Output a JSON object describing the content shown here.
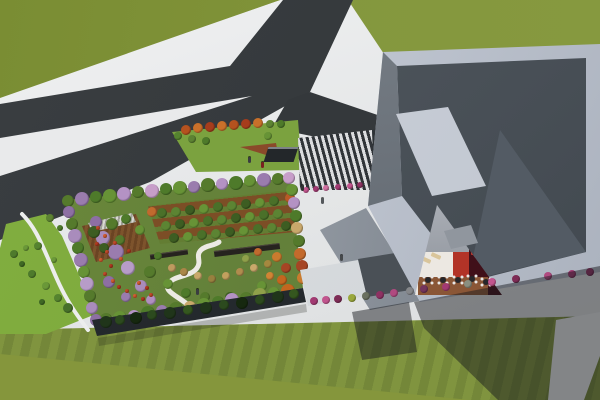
{
  "meta": {
    "description": "Aerial 3D architectural rendering: forked dark road through green field (top-left), long low building with colorful rooftop garden (center-left), large angular grey building with skylights and sunken courtyard terrace (right), striped lawns, pink street bushes and long cast shadows (bottom)."
  },
  "palette": {
    "grass_top": "#7f9238",
    "grass_right": "#86993f",
    "grass_plain": "#85963c",
    "lawn_stripe_a": "#80943f",
    "lawn_stripe_b": "#748739",
    "pavement": "#e7e9ea",
    "road": "#34383b",
    "road_island": "#e9eaeb",
    "patch_lawn": "#7ba23f",
    "strip_green": "#82af40",
    "garden_lawn": "#6c8a3b",
    "orchard_soil": "#7c4e26",
    "orchard_grass": "#637d33",
    "deck_a": "#6b4423",
    "deck_b": "#7d532c",
    "facade": "#22272b",
    "parapet_hi": "#d6dbe4",
    "parapet_lo": "#a9b0bc",
    "roof_hi": "#5a6269",
    "roof_lo": "#40474e",
    "skylight": "#ced3db",
    "wall_hi": "#b3b9c0",
    "wall_lo": "#6e757d",
    "annex_light": "#dfe2e5",
    "annex_dark": "#4a5056",
    "court_wall": "#989da5",
    "court_white": "#ece8e2",
    "court_red": "#b23327",
    "court_maroon": "#401019",
    "court_brown": "#8a5636",
    "path_white": "#eceae4",
    "shadow": "rgba(22,26,30,0.48)"
  },
  "scene": {
    "dot_groups": {
      "patch_trees": [
        [
          186,
          130,
          5,
          "#b5521f"
        ],
        [
          198,
          128,
          5,
          "#c9702a"
        ],
        [
          210,
          127,
          5,
          "#a63c1c"
        ],
        [
          222,
          126,
          5,
          "#c9702a"
        ],
        [
          234,
          125,
          5,
          "#b5521f"
        ],
        [
          246,
          124,
          5,
          "#a63c1c"
        ],
        [
          258,
          123,
          5,
          "#c9702a"
        ],
        [
          270,
          124,
          4,
          "#5d8333"
        ],
        [
          281,
          124,
          4,
          "#4e7a2a"
        ],
        [
          178,
          136,
          4,
          "#55832f"
        ],
        [
          192,
          139,
          4,
          "#5d8333"
        ],
        [
          206,
          141,
          4,
          "#4e7a2a"
        ],
        [
          268,
          136,
          4,
          "#679336"
        ]
      ],
      "plaza_flowers": [
        [
          306,
          190,
          3,
          "#c2558e"
        ],
        [
          316,
          189,
          3,
          "#a23a72"
        ],
        [
          326,
          188,
          3,
          "#d06fa0"
        ],
        [
          338,
          187,
          3,
          "#a23a72"
        ],
        [
          350,
          186,
          3,
          "#c2558e"
        ],
        [
          360,
          185,
          3,
          "#8e3263"
        ]
      ],
      "strip_bushes": [
        [
          14,
          254,
          4,
          "#4e7a2c"
        ],
        [
          26,
          248,
          3,
          "#6a9838"
        ],
        [
          38,
          246,
          4,
          "#55832f"
        ],
        [
          22,
          264,
          3,
          "#3f6824"
        ],
        [
          32,
          274,
          4,
          "#4e7a2c"
        ],
        [
          46,
          286,
          4,
          "#6a9838"
        ],
        [
          58,
          298,
          4,
          "#55832f"
        ],
        [
          68,
          308,
          5,
          "#47702a"
        ],
        [
          42,
          302,
          3,
          "#3f6824"
        ],
        [
          54,
          260,
          3,
          "#6a9838"
        ],
        [
          50,
          218,
          4,
          "#5d8333"
        ],
        [
          60,
          228,
          3,
          "#4e7a2a"
        ]
      ],
      "garden_interior": [
        [
          103,
          238,
          7,
          "#a98cbc"
        ],
        [
          116,
          252,
          8,
          "#9a7cae"
        ],
        [
          128,
          268,
          7,
          "#b79cc8"
        ],
        [
          109,
          282,
          6,
          "#8d6fa3"
        ],
        [
          141,
          286,
          6,
          "#a98cbc"
        ],
        [
          126,
          297,
          5,
          "#9a7cae"
        ],
        [
          96,
          222,
          6,
          "#8d6fa3"
        ],
        [
          151,
          300,
          5,
          "#b08fc0"
        ],
        [
          94,
          232,
          6,
          "#3d5d22"
        ],
        [
          112,
          224,
          6,
          "#557a2c"
        ],
        [
          126,
          219,
          5,
          "#4e7a2a"
        ],
        [
          140,
          230,
          5,
          "#679336"
        ],
        [
          104,
          248,
          5,
          "#3d5d22"
        ],
        [
          120,
          240,
          5,
          "#557a2c"
        ],
        [
          150,
          272,
          6,
          "#557a2c"
        ],
        [
          168,
          284,
          5,
          "#679336"
        ],
        [
          186,
          293,
          5,
          "#4e7a2a"
        ],
        [
          205,
          297,
          5,
          "#557a2c"
        ],
        [
          230,
          297,
          5,
          "#3d5d22"
        ],
        [
          262,
          286,
          5,
          "#679336"
        ],
        [
          158,
          256,
          4,
          "#4e7a2a"
        ],
        [
          172,
          268,
          4,
          "#bf9a5f"
        ],
        [
          184,
          272,
          4,
          "#aa8648"
        ],
        [
          198,
          276,
          4,
          "#c9a86b"
        ],
        [
          212,
          279,
          4,
          "#98803f"
        ],
        [
          226,
          276,
          4,
          "#c2a05e"
        ],
        [
          240,
          272,
          4,
          "#b08c4e"
        ],
        [
          254,
          268,
          4,
          "#c9a86b"
        ],
        [
          268,
          264,
          4,
          "#a5883f"
        ],
        [
          246,
          259,
          4,
          "#8fa04a"
        ],
        [
          258,
          252,
          4,
          "#c06a2e"
        ],
        [
          277,
          257,
          5,
          "#c97b2e"
        ],
        [
          286,
          268,
          5,
          "#a64524"
        ],
        [
          282,
          280,
          5,
          "#c3661f"
        ],
        [
          270,
          276,
          4,
          "#d08434"
        ]
      ],
      "flower_dots": [
        [
          98,
          228,
          2,
          "#c0492a"
        ],
        [
          105,
          236,
          2,
          "#d15c30"
        ],
        [
          97,
          244,
          2,
          "#b03a20"
        ],
        [
          107,
          252,
          2,
          "#c0492a"
        ],
        [
          101,
          260,
          2,
          "#d15c30"
        ],
        [
          111,
          266,
          2,
          "#b03a20"
        ],
        [
          105,
          274,
          2,
          "#c0492a"
        ],
        [
          113,
          281,
          2,
          "#d15c30"
        ],
        [
          119,
          287,
          2,
          "#b03a20"
        ],
        [
          127,
          291,
          2,
          "#c0492a"
        ],
        [
          135,
          296,
          2,
          "#d15c30"
        ],
        [
          143,
          299,
          2,
          "#b03a20"
        ],
        [
          151,
          295,
          2,
          "#c0492a"
        ],
        [
          121,
          259,
          2,
          "#d15c30"
        ],
        [
          129,
          251,
          2,
          "#b03a20"
        ],
        [
          115,
          243,
          2,
          "#c0492a"
        ],
        [
          139,
          283,
          2,
          "#d15c30"
        ],
        [
          147,
          288,
          2,
          "#b03a20"
        ]
      ],
      "orchard_trees": [
        [
          162,
          213,
          5,
          "#4a7029"
        ],
        [
          176,
          212,
          5,
          "#5c8433"
        ],
        [
          190,
          210,
          5,
          "#3d5d22"
        ],
        [
          204,
          209,
          5,
          "#679336"
        ],
        [
          218,
          207,
          5,
          "#4a7029"
        ],
        [
          232,
          206,
          5,
          "#5c8433"
        ],
        [
          246,
          204,
          5,
          "#3d5d22"
        ],
        [
          260,
          203,
          5,
          "#679336"
        ],
        [
          274,
          201,
          5,
          "#4a7029"
        ],
        [
          166,
          226,
          5,
          "#5c8433"
        ],
        [
          180,
          224,
          5,
          "#3d5d22"
        ],
        [
          194,
          223,
          5,
          "#679336"
        ],
        [
          208,
          221,
          5,
          "#4a7029"
        ],
        [
          222,
          220,
          5,
          "#5c8433"
        ],
        [
          236,
          218,
          5,
          "#3d5d22"
        ],
        [
          250,
          217,
          5,
          "#679336"
        ],
        [
          264,
          215,
          5,
          "#4a7029"
        ],
        [
          278,
          214,
          5,
          "#5c8433"
        ],
        [
          174,
          238,
          5,
          "#3d5d22"
        ],
        [
          188,
          237,
          5,
          "#679336"
        ],
        [
          202,
          235,
          5,
          "#4a7029"
        ],
        [
          216,
          234,
          5,
          "#5c8433"
        ],
        [
          230,
          232,
          5,
          "#3d5d22"
        ],
        [
          244,
          231,
          5,
          "#679336"
        ],
        [
          258,
          229,
          5,
          "#4a7029"
        ],
        [
          272,
          228,
          5,
          "#5c8433"
        ],
        [
          286,
          226,
          5,
          "#3d5d22"
        ],
        [
          152,
          212,
          5,
          "#c06a2e"
        ],
        [
          290,
          198,
          5,
          "#b85a26"
        ]
      ],
      "garden_border": [
        [
          68,
          201,
          6,
          "#557a2c"
        ],
        [
          82,
          199,
          7,
          "#9a7cae"
        ],
        [
          96,
          197,
          6,
          "#4e7a2a"
        ],
        [
          110,
          196,
          7,
          "#679336"
        ],
        [
          124,
          194,
          7,
          "#b492c4"
        ],
        [
          138,
          192,
          6,
          "#557a2c"
        ],
        [
          152,
          191,
          7,
          "#c79ec9"
        ],
        [
          166,
          189,
          6,
          "#4e7a2a"
        ],
        [
          180,
          188,
          7,
          "#679336"
        ],
        [
          194,
          187,
          6,
          "#9a7cae"
        ],
        [
          208,
          185,
          7,
          "#557a2c"
        ],
        [
          222,
          184,
          6,
          "#b492c4"
        ],
        [
          236,
          183,
          7,
          "#4e7a2a"
        ],
        [
          250,
          181,
          6,
          "#679336"
        ],
        [
          264,
          180,
          7,
          "#9a7cae"
        ],
        [
          278,
          179,
          6,
          "#557a2c"
        ],
        [
          289,
          178,
          6,
          "#c79ec9"
        ],
        [
          292,
          190,
          6,
          "#679336"
        ],
        [
          294,
          203,
          6,
          "#b492c4"
        ],
        [
          296,
          216,
          6,
          "#4e7a2a"
        ],
        [
          297,
          228,
          6,
          "#c9a86b"
        ],
        [
          299,
          241,
          6,
          "#557a2c"
        ],
        [
          300,
          254,
          6,
          "#c36a2c"
        ],
        [
          302,
          266,
          6,
          "#a64524"
        ],
        [
          303,
          278,
          6,
          "#c97b2e"
        ],
        [
          288,
          291,
          7,
          "#c3661f"
        ],
        [
          274,
          293,
          6,
          "#679336"
        ],
        [
          260,
          295,
          7,
          "#8fa04a"
        ],
        [
          246,
          298,
          6,
          "#557a2c"
        ],
        [
          232,
          300,
          7,
          "#b492c4"
        ],
        [
          218,
          302,
          6,
          "#4e7a2a"
        ],
        [
          204,
          305,
          7,
          "#679336"
        ],
        [
          190,
          307,
          6,
          "#c9a86b"
        ],
        [
          176,
          309,
          7,
          "#557a2c"
        ],
        [
          162,
          311,
          6,
          "#9a7cae"
        ],
        [
          148,
          313,
          7,
          "#4e7a2a"
        ],
        [
          134,
          316,
          6,
          "#b492c4"
        ],
        [
          120,
          318,
          7,
          "#679336"
        ],
        [
          106,
          319,
          6,
          "#557a2c"
        ],
        [
          96,
          320,
          6,
          "#8d6fa3"
        ],
        [
          69,
          212,
          6,
          "#8d6fa3"
        ],
        [
          72,
          224,
          6,
          "#557a2c"
        ],
        [
          75,
          236,
          7,
          "#a98cbc"
        ],
        [
          78,
          248,
          6,
          "#4e7a2a"
        ],
        [
          81,
          260,
          7,
          "#9a7cae"
        ],
        [
          84,
          272,
          6,
          "#679336"
        ],
        [
          87,
          284,
          7,
          "#b79cc8"
        ],
        [
          90,
          296,
          6,
          "#557a2c"
        ],
        [
          92,
          308,
          6,
          "#a98cbc"
        ]
      ],
      "facade_bushes": [
        [
          106,
          322,
          6,
          "#20351a"
        ],
        [
          120,
          320,
          5,
          "#2c4a1e"
        ],
        [
          136,
          318,
          6,
          "#16280f"
        ],
        [
          152,
          315,
          5,
          "#2c4a1e"
        ],
        [
          170,
          313,
          6,
          "#20351a"
        ],
        [
          188,
          310,
          5,
          "#35571f"
        ],
        [
          206,
          308,
          6,
          "#20351a"
        ],
        [
          224,
          305,
          5,
          "#2c4a1e"
        ],
        [
          242,
          303,
          6,
          "#16280f"
        ],
        [
          260,
          300,
          5,
          "#2c4a1e"
        ],
        [
          278,
          297,
          6,
          "#20351a"
        ],
        [
          294,
          294,
          5,
          "#35571f"
        ]
      ],
      "street_bushes": [
        [
          314,
          301,
          4,
          "#a23a72"
        ],
        [
          326,
          300,
          4,
          "#c2558e"
        ],
        [
          338,
          299,
          4,
          "#7e2c56"
        ],
        [
          352,
          298,
          4,
          "#9aa83c"
        ],
        [
          366,
          296,
          4,
          "#6a705f"
        ],
        [
          380,
          295,
          4,
          "#8e3263"
        ],
        [
          394,
          293,
          4,
          "#b04a80"
        ],
        [
          410,
          291,
          4,
          "#85878a"
        ],
        [
          424,
          289,
          4,
          "#74355c"
        ],
        [
          446,
          287,
          4,
          "#a23a72"
        ],
        [
          468,
          284,
          4,
          "#8a8f80"
        ],
        [
          492,
          282,
          4,
          "#c2558e"
        ],
        [
          516,
          279,
          4,
          "#7e2c56"
        ],
        [
          548,
          276,
          4,
          "#b04a80"
        ],
        [
          572,
          274,
          4,
          "#a23a72"
        ],
        [
          590,
          272,
          4,
          "#8e3263"
        ]
      ]
    },
    "people": [
      [
        248,
        157,
        "#3a3d40"
      ],
      [
        261,
        162,
        "#7a2020"
      ],
      [
        301,
        185,
        "#2e3133"
      ],
      [
        321,
        198,
        "#54585b"
      ],
      [
        196,
        289,
        "#3a3d40"
      ],
      [
        340,
        255,
        "#46494c"
      ]
    ],
    "tables": [
      [
        428,
        280
      ],
      [
        443,
        280
      ],
      [
        458,
        280
      ],
      [
        472,
        279
      ],
      [
        486,
        282
      ]
    ]
  }
}
